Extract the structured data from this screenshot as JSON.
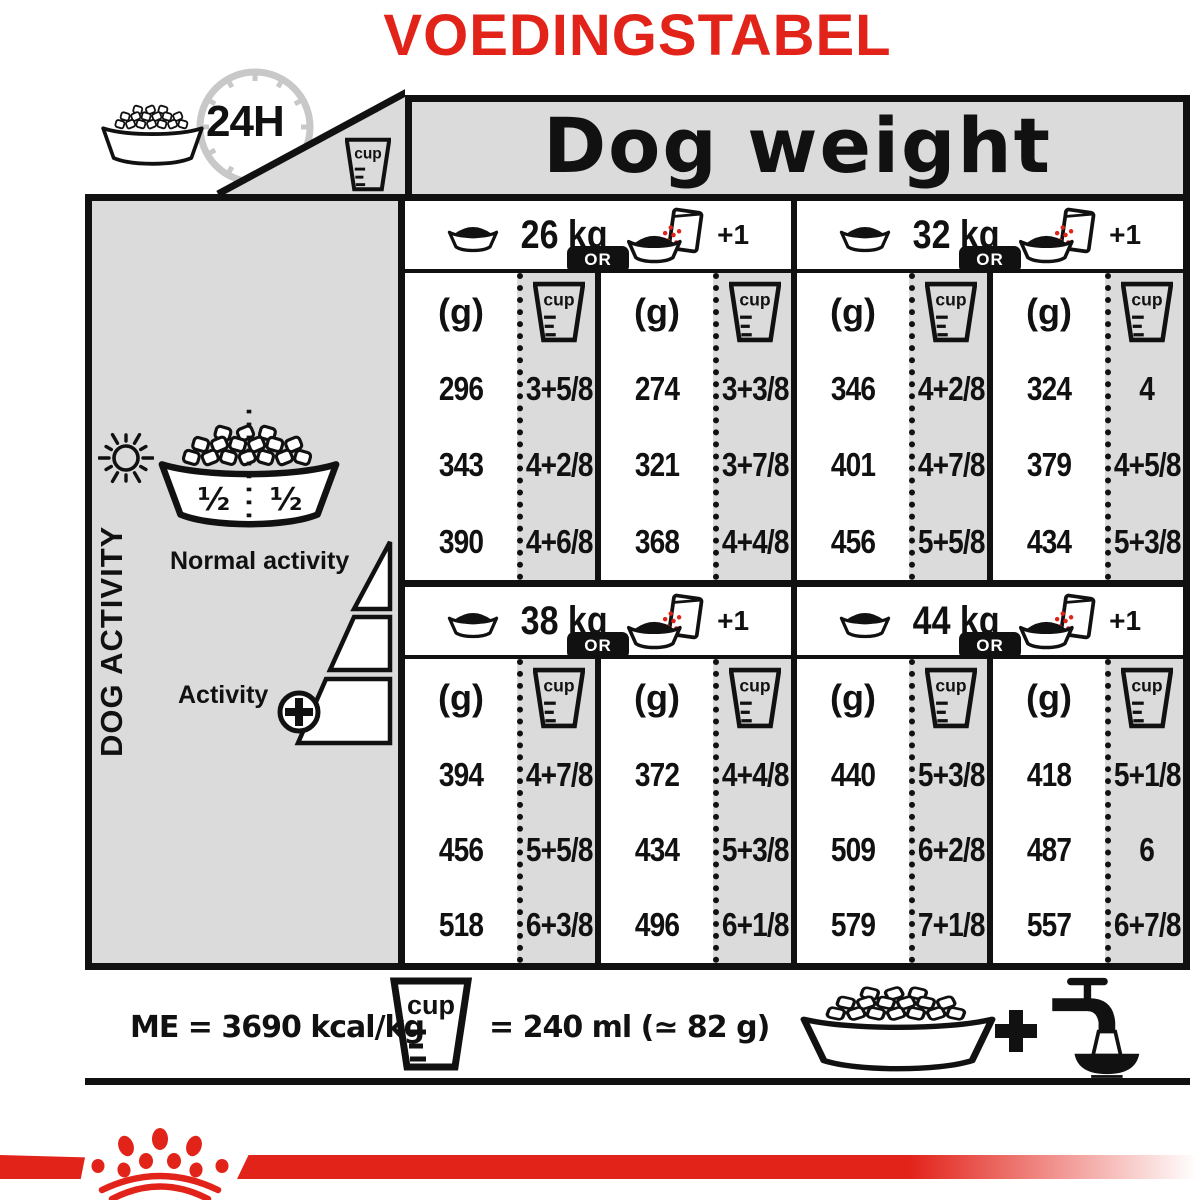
{
  "title": "VOEDINGSTABEL",
  "colors": {
    "accent_red": "#e2231a",
    "panel_gray": "#dbdbdb",
    "ink": "#111111",
    "clock_gray": "#c8c8c8"
  },
  "header": {
    "daily_label": "24H",
    "dog_weight": "Dog weight"
  },
  "icons": {
    "cup_label": "cup",
    "kibble_bowl": "kibble-bowl-icon",
    "clock": "24h-clock-icon",
    "measuring_cup": "measuring-cup-icon",
    "sun": "sun-icon",
    "moon": "moon-icon",
    "half_half_bowl": "half-half-bowl-icon",
    "dry_bowl": "dry-food-bowl-icon",
    "wet_pouch": "bowl-plus-wet-pouch-icon",
    "plus": "plus-icon",
    "tap": "water-tap-icon",
    "crown": "royal-canin-crown-logo"
  },
  "sidebar": {
    "vertical_label": "DOG ACTIVITY",
    "normal_activity": "Normal activity",
    "activity": "Activity",
    "half_left": "½",
    "half_right": "½"
  },
  "feeding_table": {
    "unit_g": "(g)",
    "or_label": "OR",
    "plus_one_label": "+1",
    "quadrants": [
      {
        "weight": "26 kg",
        "kibble_only": {
          "g": [
            "296",
            "343",
            "390"
          ],
          "cups": [
            "3+5/8",
            "4+2/8",
            "4+6/8"
          ]
        },
        "kibble_plus_wet": {
          "g": [
            "274",
            "321",
            "368"
          ],
          "cups": [
            "3+3/8",
            "3+7/8",
            "4+4/8"
          ]
        }
      },
      {
        "weight": "32 kg",
        "kibble_only": {
          "g": [
            "346",
            "401",
            "456"
          ],
          "cups": [
            "4+2/8",
            "4+7/8",
            "5+5/8"
          ]
        },
        "kibble_plus_wet": {
          "g": [
            "324",
            "379",
            "434"
          ],
          "cups": [
            "4",
            "4+5/8",
            "5+3/8"
          ]
        }
      },
      {
        "weight": "38 kg",
        "kibble_only": {
          "g": [
            "394",
            "456",
            "518"
          ],
          "cups": [
            "4+7/8",
            "5+5/8",
            "6+3/8"
          ]
        },
        "kibble_plus_wet": {
          "g": [
            "372",
            "434",
            "496"
          ],
          "cups": [
            "4+4/8",
            "5+3/8",
            "6+1/8"
          ]
        }
      },
      {
        "weight": "44 kg",
        "kibble_only": {
          "g": [
            "440",
            "509",
            "579"
          ],
          "cups": [
            "5+3/8",
            "6+2/8",
            "7+1/8"
          ]
        },
        "kibble_plus_wet": {
          "g": [
            "418",
            "487",
            "557"
          ],
          "cups": [
            "5+1/8",
            "6",
            "6+7/8"
          ]
        }
      }
    ]
  },
  "footer": {
    "energy": "ME = 3690 kcal/kg",
    "cup_equiv": "= 240 ml (≃ 82 g)"
  }
}
